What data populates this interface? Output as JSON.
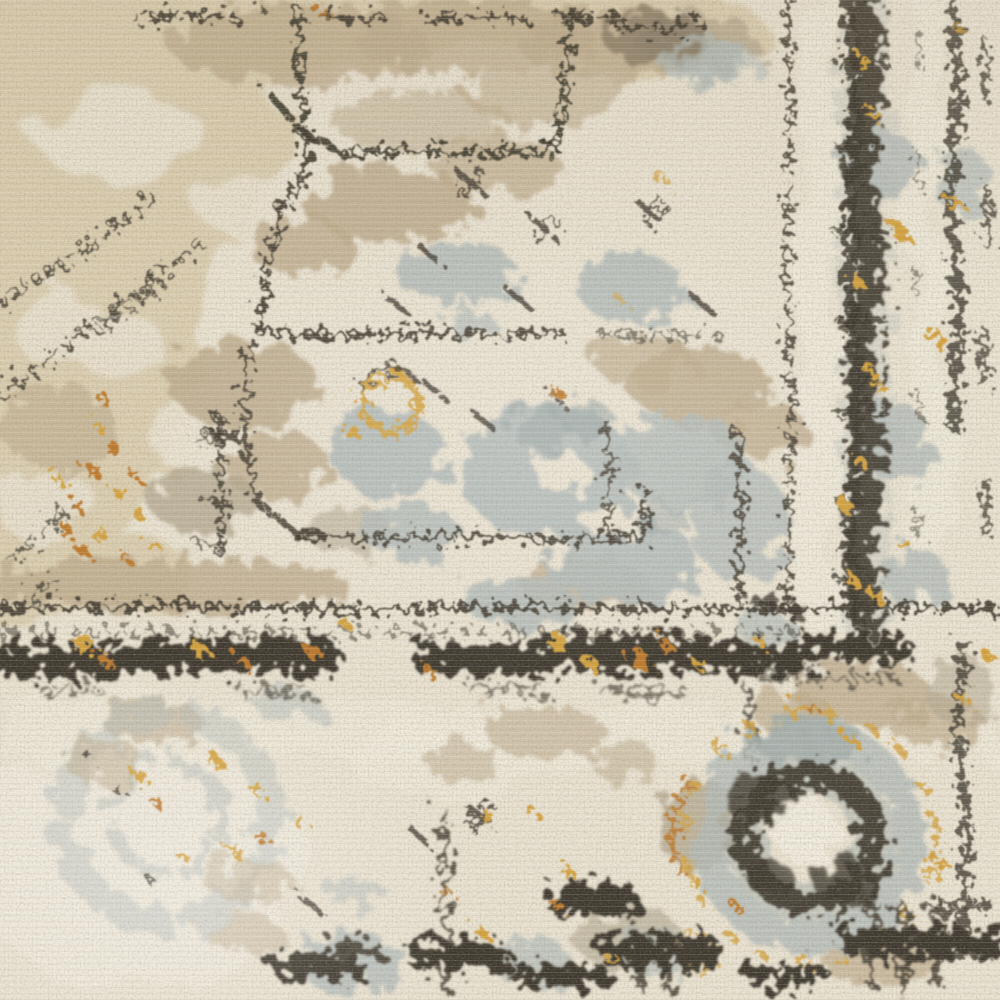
{
  "scene": {
    "subject": "Distressed vintage-style oriental rug, overhead close-up",
    "caption": "Close-up of an ivory and beige vintage-distressed oriental rug: a warm sand corner field upper left, broken charcoal stitch lines tracing a stepped medallion, faded grey-blue pattern patches, an ornate dark border column on the right, a horizontal ornament band with gold and rust flecks, and two rosette medallions in the lower half.",
    "texture": "cut-pile carpet with fine horizontal weave ridges"
  },
  "palette": {
    "cream": "#ece5d4",
    "cream_bright": "#f4efe2",
    "sand": "#ddd0b2",
    "taupe": "#c0ae8f",
    "warm_gray": "#b3a78f",
    "gray_blue": "#b4bdbb",
    "slate": "#9aa8a8",
    "charcoal": "#3e392e",
    "charcoal_soft": "#5b5342",
    "gold": "#d7a43c",
    "rust": "#c07a2b"
  },
  "elements": {
    "sand_corner": "Warm sand-beige field filling the upper-left corner with cream wear spots",
    "top_taupe_band": "Mottled taupe strip along the top edge",
    "medallion_outline": "Broken charcoal stitch lines tracing a stepped medallion in the upper field",
    "interior_sprigs": "Small charcoal cross-shaped sprigs scattered in the ivory field",
    "gray_blue_patches": "Faded grey-blue pattern remnants across the centre",
    "taupe_patches": "Eroded taupe-beige pattern remnants",
    "right_border_column": "Dark ornamental border column running down the right side with gold flecks",
    "right_guard_line": "Thin broken guard stripe left of the border column",
    "horizontal_guard_line": "Broken charcoal guard line crossing the rug near two-thirds height",
    "ornament_band": "Horizontal band of dark geometric ornaments with gold and rust accents",
    "rosette_left": "Faded grey-blue rosette with gold flecks, lower left",
    "rosette_right": "Bold rosette with grey-blue halo, charcoal ring and ivory core, lower right",
    "bottom_ornament_row": "Partial row of dark border ornaments along the bottom edge",
    "gold_accents": "Scattered ochre-gold and rust flecks, including a cone-shaped cascade at mid-left",
    "pile_texture": "Fine horizontal pile ridges",
    "photo_grain": "Photographic grain"
  }
}
